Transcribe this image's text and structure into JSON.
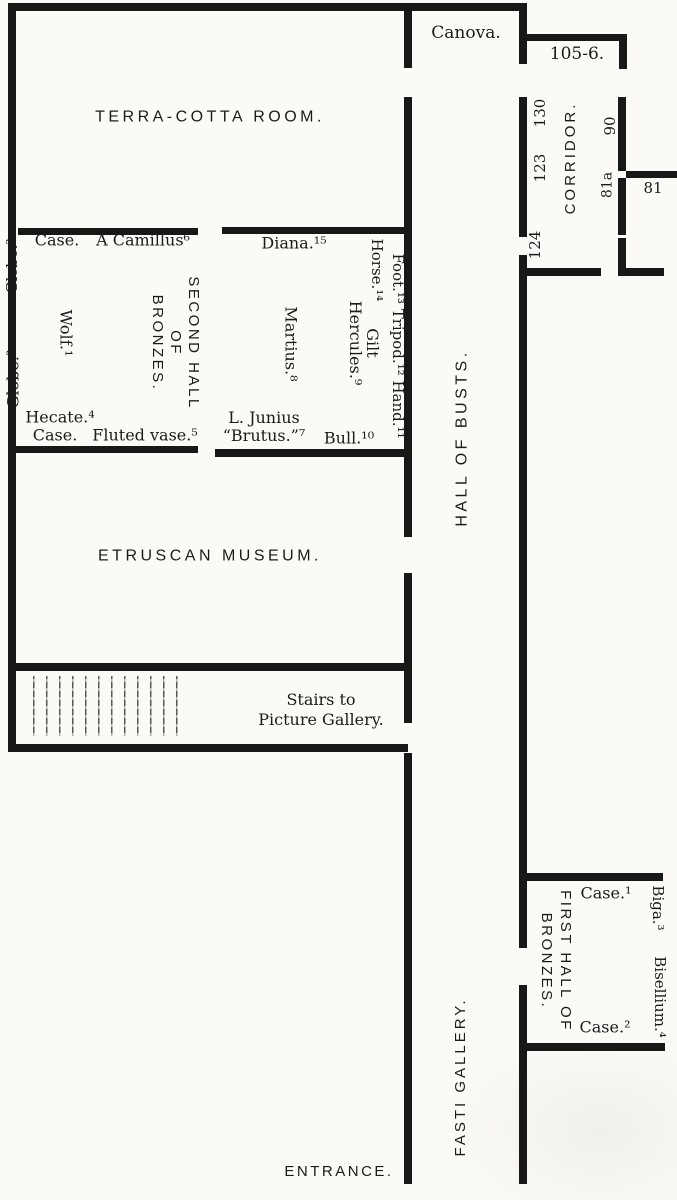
{
  "plan_title": "Museum floor plan",
  "colors": {
    "ink": "#181818",
    "paper": "#fbfaf7"
  },
  "rooms": {
    "terra_cotta": "TERRA-COTTA ROOM.",
    "canova": "Canova.",
    "room_105_6": "105-6.",
    "corridor": "CORRIDOR.",
    "hall_of_busts": "HALL OF BUSTS.",
    "etruscan_museum": "ETRUSCAN MUSEUM.",
    "fasti_gallery": "FASTI GALLERY.",
    "entrance": "ENTRANCE.",
    "stairs_line1": "Stairs to",
    "stairs_line2": "Picture Gallery.",
    "second_hall_line1": "SECOND HALL",
    "second_hall_line2": "OF",
    "second_hall_line3": "BRONZES.",
    "first_hall_line1": "FIRST HALL OF",
    "first_hall_line2": "BRONZES."
  },
  "second_hall_exhibits": {
    "case_top": "Case.",
    "camillus": "A Camillus⁶",
    "globe_upper": "Globe.²",
    "globe_lower": "Globe.³",
    "wolf": "Wolf.¹",
    "hecate": "Hecate.⁴",
    "case_bottom": "Case.",
    "fluted_vase": "Fluted vase.⁵"
  },
  "diana_room_exhibits": {
    "diana": "Diana.¹⁵",
    "foot_tripod_hand": "Foot.¹³ Tripod.¹² Hand.¹¹",
    "horse": "Horse.¹⁴",
    "gilt": "Gilt",
    "hercules": "Hercules.⁹",
    "martius": "Martius.⁸",
    "junius_line1": "L. Junius",
    "junius_line2": "“Brutus.”⁷",
    "bull": "Bull.¹⁰"
  },
  "first_hall_exhibits": {
    "case1": "Case.¹",
    "case2": "Case.²",
    "biga": "Biga.³",
    "bisellium": "Bisellium.⁴"
  },
  "room_numbers": {
    "n130": "130",
    "n123": "123",
    "n124": "124",
    "n90": "90",
    "n81a": "81a",
    "n81": "81"
  }
}
